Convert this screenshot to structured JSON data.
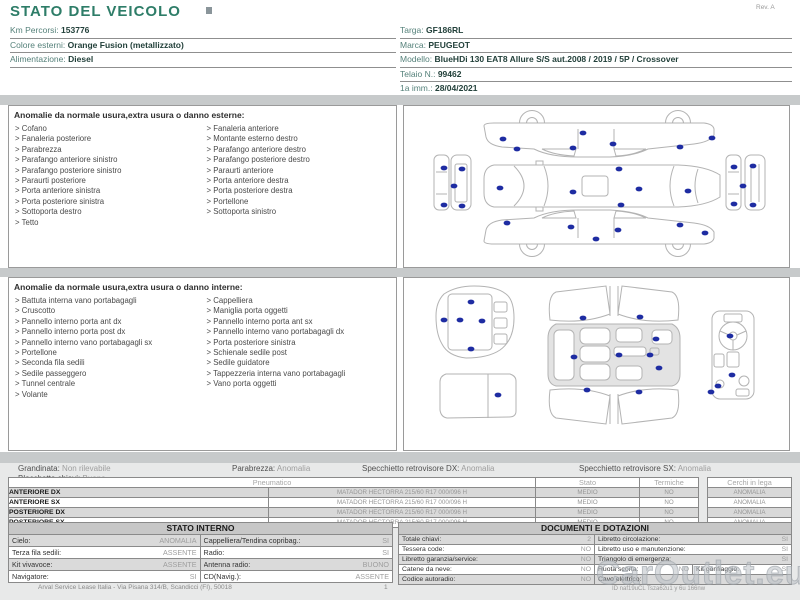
{
  "header": {
    "title": "STATO DEL VEICOLO",
    "rev": "Rev. A",
    "left_fields": [
      {
        "label": "Km Percorsi:",
        "value": "153776"
      },
      {
        "label": "Colore esterni:",
        "value": "Orange Fusion (metallizzato)"
      },
      {
        "label": "Alimentazione:",
        "value": "Diesel"
      }
    ],
    "right_fields": [
      {
        "label": "Targa:",
        "value": "GF186RL"
      },
      {
        "label": "Marca:",
        "value": "PEUGEOT"
      },
      {
        "label": "Modello:",
        "value": "BlueHDi 130 EAT8 Allure S/S aut.2008 / 2019 / 5P / Crossover"
      },
      {
        "label": "Telaio N.:",
        "value": "99462"
      },
      {
        "label": "1a imm.:",
        "value": "28/04/2021"
      }
    ]
  },
  "exterior": {
    "title": "Anomalie da normale usura,extra usura o danno esterne:",
    "col1": [
      "Cofano",
      "Fanaleria posteriore",
      "Parabrezza",
      "Parafango anteriore sinistro",
      "Parafango posteriore sinistro",
      "Paraurti posteriore",
      "Porta anteriore sinistra",
      "Porta posteriore sinistra",
      "Sottoporta destro",
      "Tetto"
    ],
    "col2": [
      "Fanaleria anteriore",
      "Montante esterno destro",
      "Parafango anteriore destro",
      "Parafango posteriore destro",
      "Paraurti anteriore",
      "Porta anteriore destra",
      "Porta posteriore destra",
      "Portellone",
      "Sottoporta sinistro"
    ]
  },
  "interior": {
    "title": "Anomalie da normale usura,extra usura o danno interne:",
    "col1": [
      "Battuta interna vano portabagagli",
      "Cruscotto",
      "Pannello interno porta ant dx",
      "Pannello interno porta post dx",
      "Pannello interno vano portabagagli sx",
      "Portellone",
      "Seconda fila sedili",
      "Sedile passeggero",
      "Tunnel centrale",
      "Volante"
    ],
    "col2": [
      "Cappelliera",
      "Maniglia porta oggetti",
      "Pannello interno porta ant sx",
      "Pannello interno vano portabagagli dx",
      "Porta posteriore sinistra",
      "Schienale sedile post",
      "Sedile guidatore",
      "Tappezzeria interna vano portabagagli",
      "Vano porta oggetti"
    ]
  },
  "summary": [
    {
      "label": "Grandinata:",
      "value": "Non rilevabile"
    },
    {
      "label": "Blocchetto chiavi:",
      "value": "Buono"
    },
    {
      "label": "Parabrezza:",
      "value": "Anomalia"
    },
    {
      "label": "Specchietto retrovisore DX:",
      "value": "Anomalia"
    },
    {
      "label": "Specchietto retrovisore SX:",
      "value": "Anomalia"
    }
  ],
  "tyres": {
    "col_pneumatico": "Pneumatico",
    "col_stato": "Stato",
    "col_termiche": "Termiche",
    "col_cerchi": "Cerchi in lega",
    "rows": [
      {
        "pos": "ANTERIORE DX",
        "tyre": "MATADOR HECTORRA 215/60 R17 000/096 H",
        "stato": "MEDIO",
        "termiche": "NO",
        "cerchi": "ANOMALIA"
      },
      {
        "pos": "ANTERIORE SX",
        "tyre": "MATADOR HECTORRA 215/60 R17 000/096 H",
        "stato": "MEDIO",
        "termiche": "NO",
        "cerchi": "ANOMALIA"
      },
      {
        "pos": "POSTERIORE DX",
        "tyre": "MATADOR HECTORRA 215/60 R17 000/096 H",
        "stato": "MEDIO",
        "termiche": "NO",
        "cerchi": "ANOMALIA"
      },
      {
        "pos": "POSTERIORE SX",
        "tyre": "MATADOR HECTORRA 215/60 R17 000/096 H",
        "stato": "MEDIO",
        "termiche": "NO",
        "cerchi": "ANOMALIA"
      }
    ]
  },
  "stato_interno": {
    "title": "STATO INTERNO",
    "rows": [
      {
        "l1": "Cielo:",
        "v1": "ANOMALIA",
        "l2": "Cappelliera/Tendina copribag.:",
        "v2": "SI"
      },
      {
        "l1": "Terza fila sedili:",
        "v1": "ASSENTE",
        "l2": "Radio:",
        "v2": "SI"
      },
      {
        "l1": "Kit vivavoce:",
        "v1": "ASSENTE",
        "l2": "Antenna radio:",
        "v2": "BUONO"
      },
      {
        "l1": "Navigatore:",
        "v1": "SI",
        "l2": "CD(Navig.):",
        "v2": "ASSENTE"
      }
    ]
  },
  "documenti": {
    "title": "DOCUMENTI E DOTAZIONI",
    "rows": [
      {
        "l1": "Totale chiavi:",
        "v1": "2",
        "l2": "Libretto circolazione:",
        "v2": "SI"
      },
      {
        "l1": "Tessera code:",
        "v1": "NO",
        "l2": "Libretto uso e manutenzione:",
        "v2": "SI"
      },
      {
        "l1": "Libretto garanzia/service:",
        "v1": "NO",
        "l2": "Triangolo di emergenza:",
        "v2": "SI"
      },
      {
        "l1": "Catene da neve:",
        "v1": "NO",
        "l2": "Ruota scorta:",
        "v2": "NO",
        "l3": "Kit gonfiaggio:",
        "v3": "SI"
      },
      {
        "l1": "Codice autoradio:",
        "v1": "NO",
        "l2": "Cavo elettrico:",
        "v2": ""
      }
    ]
  },
  "footer": {
    "company": "Arval Service Lease Italia - Via Pisana 314/B, Scandicci (FI), 50018",
    "page": "1",
    "watermark": "CarOutlet.eu",
    "doc_code": "ID naf19uCL Tsza62u1 y 6u 166nw"
  },
  "colors": {
    "accent": "#2e7d68",
    "damage_dot": "#1e2ca2",
    "band_gray": "#c7cacb",
    "alt_row_gray": "#d9d9d9"
  }
}
